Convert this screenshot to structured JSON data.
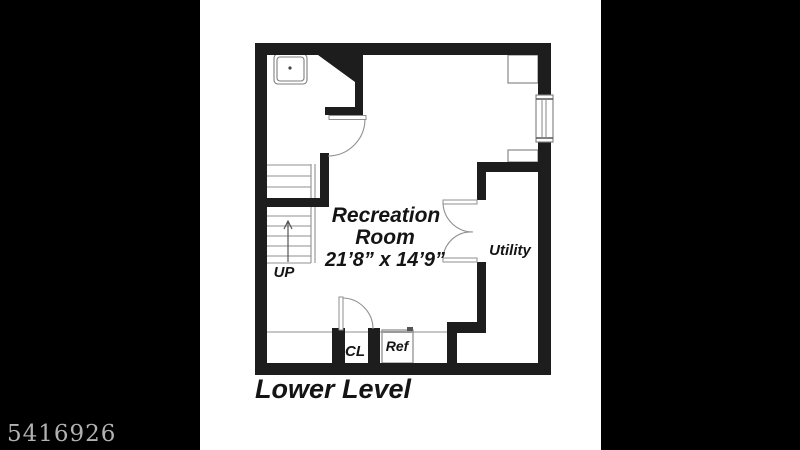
{
  "watermark": {
    "id": "5416926"
  },
  "floor_plan": {
    "title": "Lower Level",
    "rooms": {
      "recreation": {
        "name_line1": "Recreation",
        "name_line2": "Room",
        "dimensions": "21’8” x 14’9”"
      },
      "utility": {
        "label": "Utility"
      },
      "closet": {
        "label": "CL"
      },
      "refrigerator": {
        "label": "Ref"
      },
      "stairs": {
        "label": "UP"
      }
    },
    "colors": {
      "wall": "#1d1d1d",
      "plan_background": "#ffffff",
      "thin_line": "#8f8f8f",
      "letterbox": "#000000",
      "watermark_text": "#c6c6c6"
    }
  }
}
